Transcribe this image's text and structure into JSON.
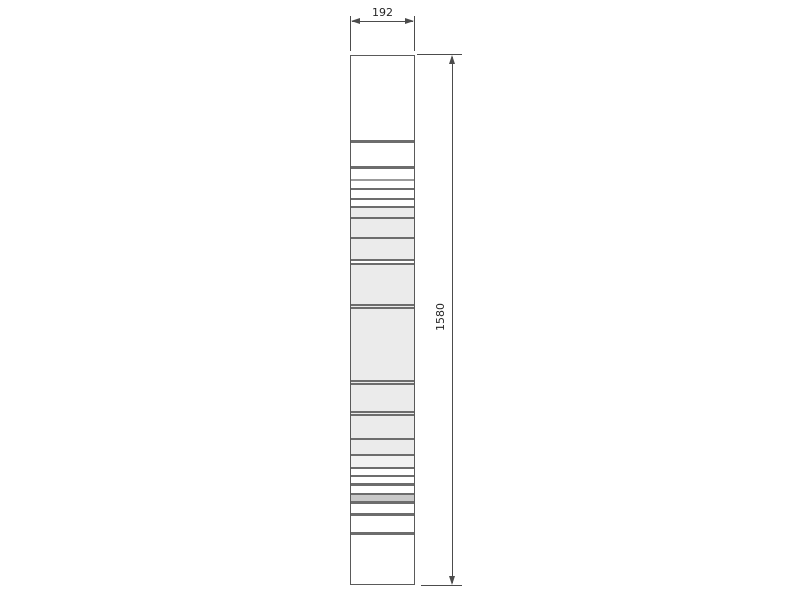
{
  "drawing": {
    "dimensions": {
      "width_label": "192",
      "height_label": "1580"
    },
    "colors": {
      "outline": "#5a5a5a",
      "dimension_line": "#4c4c4c",
      "text": "#262626",
      "W": "#ffffff",
      "L": "#ebebeb",
      "L2": "#f2f2f2",
      "D": "#6d6d6d",
      "M": "#9b9b9b",
      "G": "#c9c9c9"
    },
    "column": {
      "segments": [
        {
          "h": 84,
          "c": "W"
        },
        {
          "h": 3,
          "c": "D"
        },
        {
          "h": 23,
          "c": "W"
        },
        {
          "h": 3,
          "c": "D"
        },
        {
          "h": 10,
          "c": "W"
        },
        {
          "h": 2,
          "c": "M"
        },
        {
          "h": 7,
          "c": "W"
        },
        {
          "h": 2,
          "c": "D"
        },
        {
          "h": 8,
          "c": "W"
        },
        {
          "h": 2,
          "c": "D"
        },
        {
          "h": 6,
          "c": "W"
        },
        {
          "h": 2,
          "c": "D"
        },
        {
          "h": 9,
          "c": "L"
        },
        {
          "h": 2,
          "c": "D"
        },
        {
          "h": 18,
          "c": "L"
        },
        {
          "h": 2,
          "c": "D"
        },
        {
          "h": 20,
          "c": "L"
        },
        {
          "h": 2,
          "c": "D"
        },
        {
          "h": 2,
          "c": "W"
        },
        {
          "h": 2,
          "c": "D"
        },
        {
          "h": 39,
          "c": "L"
        },
        {
          "h": 2,
          "c": "D"
        },
        {
          "h": 1,
          "c": "L"
        },
        {
          "h": 2,
          "c": "D"
        },
        {
          "h": 71,
          "c": "L"
        },
        {
          "h": 2,
          "c": "D"
        },
        {
          "h": 1,
          "c": "L"
        },
        {
          "h": 2,
          "c": "D"
        },
        {
          "h": 26,
          "c": "L"
        },
        {
          "h": 2,
          "c": "D"
        },
        {
          "h": 1,
          "c": "L"
        },
        {
          "h": 2,
          "c": "D"
        },
        {
          "h": 22,
          "c": "L"
        },
        {
          "h": 2,
          "c": "D"
        },
        {
          "h": 14,
          "c": "L"
        },
        {
          "h": 2,
          "c": "D"
        },
        {
          "h": 11,
          "c": "L2"
        },
        {
          "h": 2,
          "c": "D"
        },
        {
          "h": 6,
          "c": "W"
        },
        {
          "h": 2,
          "c": "D"
        },
        {
          "h": 6,
          "c": "W"
        },
        {
          "h": 3,
          "c": "D"
        },
        {
          "h": 7,
          "c": "W"
        },
        {
          "h": 2,
          "c": "D"
        },
        {
          "h": 6,
          "c": "G"
        },
        {
          "h": 3,
          "c": "D"
        },
        {
          "h": 9,
          "c": "W"
        },
        {
          "h": 3,
          "c": "D"
        },
        {
          "h": 16,
          "c": "W"
        },
        {
          "h": 3,
          "c": "D"
        },
        {
          "h": 48,
          "c": "W"
        }
      ]
    }
  }
}
